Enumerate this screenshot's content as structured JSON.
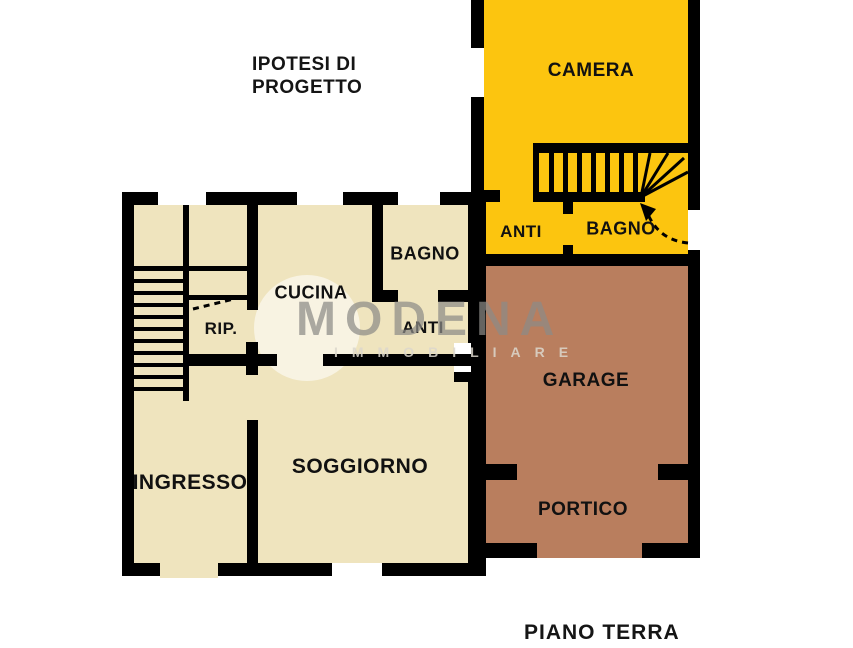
{
  "header": {
    "title": "IPOTESI DI\nPROGETTO"
  },
  "footer": {
    "floor_label": "PIANO TERRA"
  },
  "rooms": {
    "camera": "CAMERA",
    "anti_upper": "ANTI",
    "bagno_upper": "BAGNO",
    "bagno": "BAGNO",
    "cucina": "CUCINA",
    "rip": "RIP.",
    "anti": "ANTI",
    "ingresso": "INGRESSO",
    "soggiorno": "SOGGIORNO",
    "garage": "GARAGE",
    "portico": "PORTICO"
  },
  "watermark": {
    "brand": "MODENA",
    "tagline": "IMMOBILIARE"
  },
  "colors": {
    "cream": "#EFE4BE",
    "yellow": "#FCC50F",
    "brown": "#B97E5E",
    "wall": "#000000",
    "label": "#111111",
    "page-bg": "#FFFFFF"
  }
}
